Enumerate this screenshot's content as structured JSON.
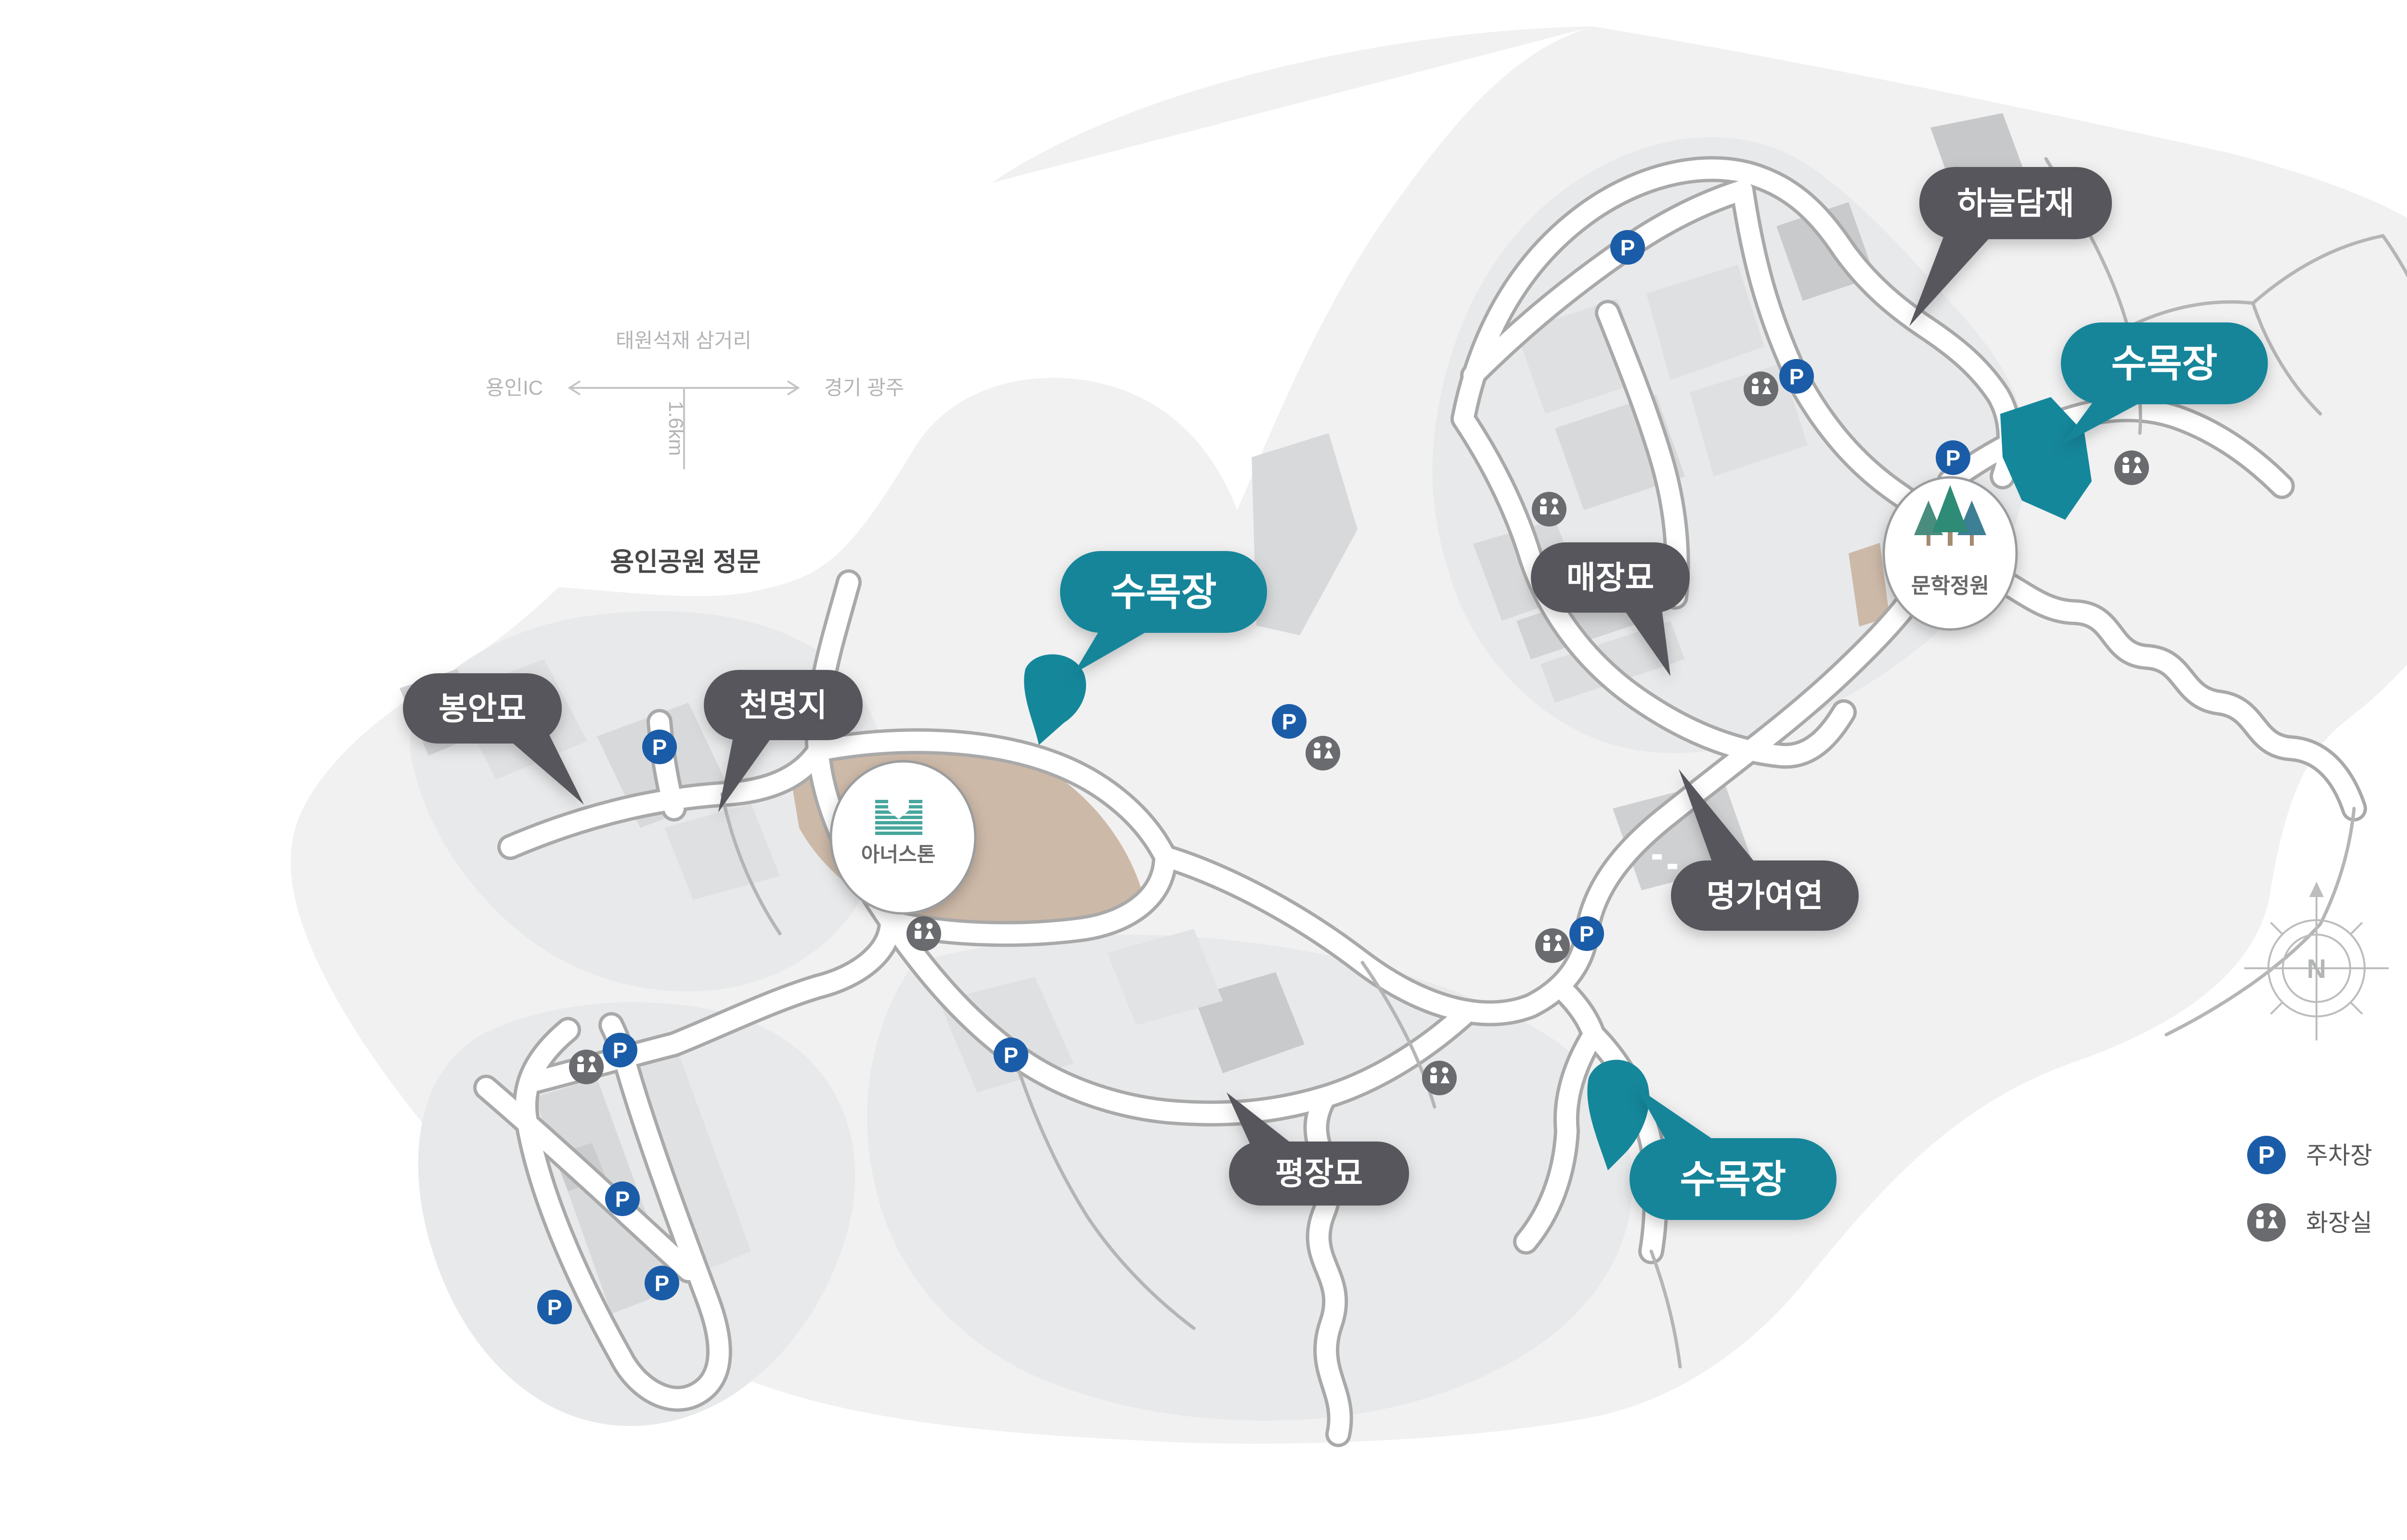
{
  "direction_diagram": {
    "junction_label": "태원석재 삼거리",
    "west_label": "용인IC",
    "east_label": "경기 광주",
    "distance_label": "1.6km",
    "gate_label": "용인공원 정문"
  },
  "badges": {
    "haneuldamjae": {
      "label": "하늘담재"
    },
    "sumokjang_top": {
      "label": "수목장"
    },
    "sumokjang_left": {
      "label": "수목장"
    },
    "sumokjang_bottom": {
      "label": "수목장"
    },
    "maejangmyo": {
      "label": "매장묘"
    },
    "bonganmyo": {
      "label": "봉안묘"
    },
    "cheonmyeongji": {
      "label": "천명지"
    },
    "myeonggayeoyeon": {
      "label": "명가여연"
    },
    "pyeongjangmyo": {
      "label": "평장묘"
    }
  },
  "landmarks": {
    "munhak_garden": {
      "label": "문학정원"
    },
    "honorstone": {
      "label": "아너스톤"
    }
  },
  "legend": {
    "parking_label": "주차장",
    "restroom_label": "화장실"
  },
  "compass": {
    "north_label": "N"
  },
  "icons": {
    "parking_glyph": "P"
  },
  "colors": {
    "teal": "#13859A",
    "map_teal": "#15879B",
    "dark_badge": "#56575B",
    "parking_blue": "#1A5CA8",
    "restroom_gray": "#6A6B6E",
    "tan": "#CDB9A8"
  },
  "markers": {
    "parking": [
      [
        3381,
        514
      ],
      [
        3732,
        782
      ],
      [
        4057,
        951
      ],
      [
        2678,
        1499
      ],
      [
        1370,
        1552
      ],
      [
        3296,
        1940
      ],
      [
        2100,
        2192
      ],
      [
        1288,
        2182
      ],
      [
        1293,
        2491
      ],
      [
        1375,
        2666
      ],
      [
        1152,
        2716
      ]
    ],
    "restroom": [
      [
        3658,
        808
      ],
      [
        4428,
        972
      ],
      [
        3218,
        1058
      ],
      [
        2748,
        1565
      ],
      [
        1919,
        1940
      ],
      [
        3225,
        1965
      ],
      [
        2990,
        2240
      ],
      [
        1218,
        2217
      ]
    ]
  }
}
